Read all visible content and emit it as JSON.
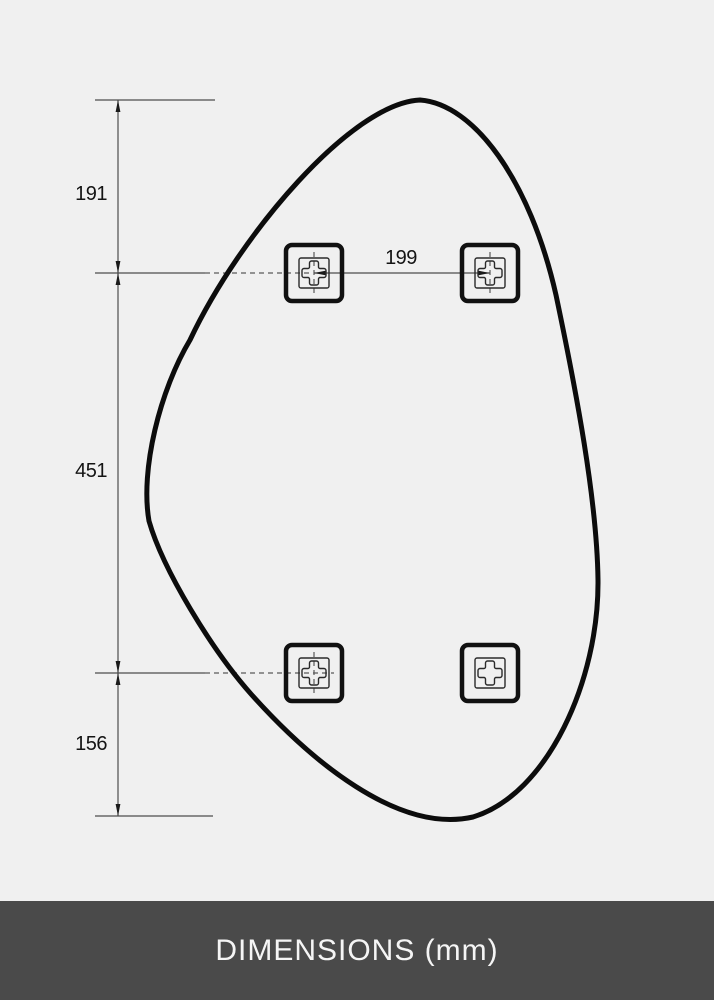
{
  "colors": {
    "background": "#f0f0f0",
    "thin_line": "#4d4d4d",
    "outline": "#0c0c0c",
    "footer_background": "#4a4a4a",
    "footer_text": "#f5f5f5"
  },
  "footer": {
    "title": "DIMENSIONS (mm)"
  },
  "drawing": {
    "unit": "mm",
    "subject": "organic-shaped-mirror-with-mounting-brackets",
    "dimension_labels": [
      {
        "id": "top-edge-to-upper-bracket-line",
        "value": "191"
      },
      {
        "id": "upper-bracket-line-to-lower-bracket-line",
        "value": "451"
      },
      {
        "id": "lower-bracket-line-to-bottom-edge",
        "value": "156"
      },
      {
        "id": "upper-bracket-horizontal-spacing",
        "value": "199"
      }
    ],
    "brackets": [
      {
        "id": "top-left"
      },
      {
        "id": "top-right"
      },
      {
        "id": "bottom-left"
      },
      {
        "id": "bottom-right"
      }
    ]
  }
}
